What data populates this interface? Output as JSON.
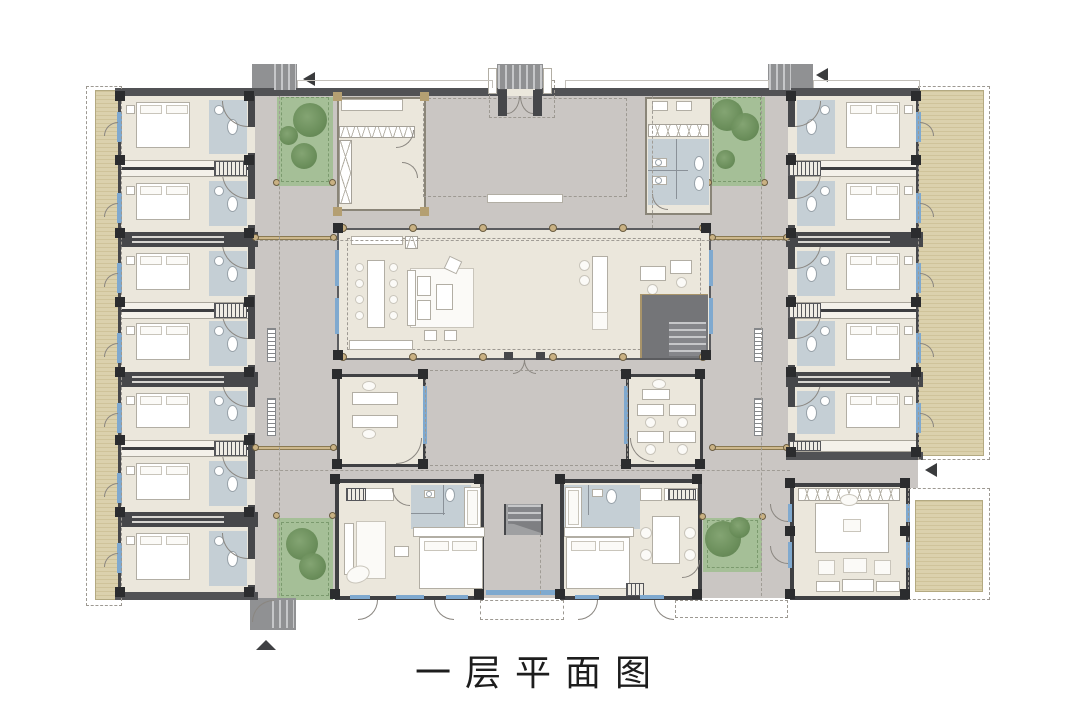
{
  "title": "一层平面图",
  "plan": {
    "type": "architectural-floor-plan",
    "level": "first-floor",
    "left_wing_guest_rooms": 7,
    "right_wing_guest_rooms": 5,
    "garden_patios": 4,
    "suites": 2,
    "areas": [
      "guest-room",
      "central-hall",
      "reception-desk",
      "dining-table",
      "lounge-sofa",
      "office",
      "stair",
      "public-restroom",
      "housekeeping-room",
      "study-room",
      "classroom",
      "suite-west",
      "suite-south",
      "tea-room",
      "veranda-deck",
      "entrance-porch",
      "garden-patio"
    ]
  },
  "colors": {
    "background": "#ffffff",
    "courtyard_gray": "#cac6c3",
    "room_cream": "#ebe7dc",
    "bathroom_blue": "#c5cfd5",
    "deck_tan": "#d8cda6",
    "garden_green": "#a5bf97",
    "tree_green": "#688c58",
    "wall_dark": "#46474a",
    "window_blue": "#7fa9cf",
    "stair_gray": "#909193",
    "column_tan": "#c9b183"
  }
}
